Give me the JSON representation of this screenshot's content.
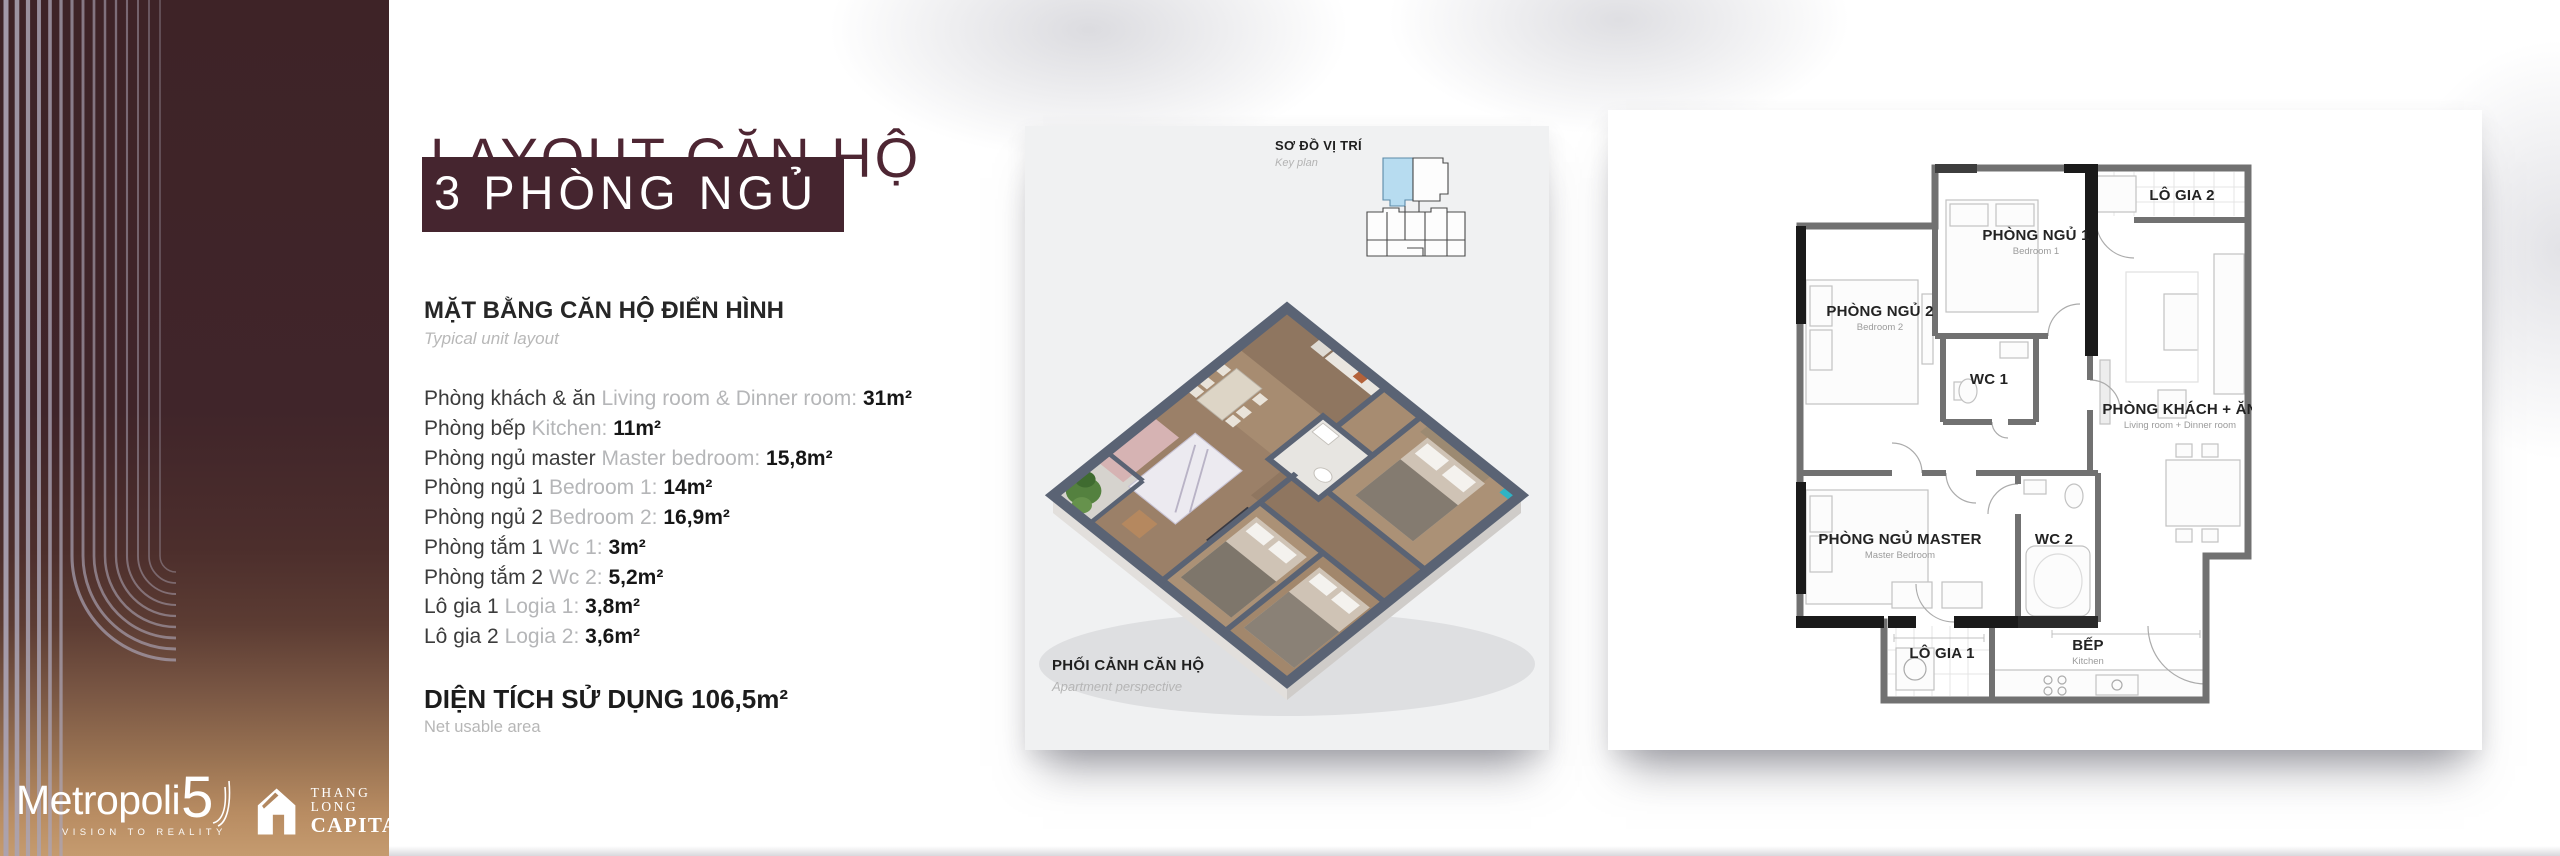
{
  "title": {
    "line1": "LAYOUT CĂN HỘ",
    "line2": "3 PHÒNG NGỦ"
  },
  "sidebar": {
    "brand": {
      "name_main": "Metropoli",
      "name_number": "5",
      "tagline": "VISION TO REALITY",
      "partner_line1": "THANG LONG",
      "partner_line2": "CAPITAL"
    }
  },
  "details": {
    "heading_vi": "MẶT BẰNG CĂN HỘ ĐIỂN HÌNH",
    "heading_en": "Typical unit layout",
    "rooms": [
      {
        "vi": "Phòng khách & ăn",
        "en": "Living room & Dinner room:",
        "area": "31m²"
      },
      {
        "vi": "Phòng bếp",
        "en": "Kitchen:",
        "area": "11m²"
      },
      {
        "vi": "Phòng ngủ master",
        "en": "Master bedroom:",
        "area": "15,8m²"
      },
      {
        "vi": "Phòng ngủ 1",
        "en": "Bedroom 1:",
        "area": "14m²"
      },
      {
        "vi": "Phòng ngủ 2",
        "en": "Bedroom 2:",
        "area": "16,9m²"
      },
      {
        "vi": "Phòng tắm 1",
        "en": "Wc 1:",
        "area": "3m²"
      },
      {
        "vi": "Phòng tắm 2",
        "en": "Wc 2:",
        "area": "5,2m²"
      },
      {
        "vi": "Lô gia 1",
        "en": "Logia 1:",
        "area": "3,8m²"
      },
      {
        "vi": "Lô gia 2",
        "en": "Logia 2:",
        "area": "3,6m²"
      }
    ],
    "total_label": "DIỆN TÍCH SỬ DỤNG",
    "total_value": "106,5m²",
    "total_en": "Net usable area"
  },
  "perspective_card": {
    "keyplan_title": "SƠ ĐỒ VỊ TRÍ",
    "keyplan_sub": "Key plan",
    "caption_title": "PHỐI CẢNH CĂN HỘ",
    "caption_sub": "Apartment perspective"
  },
  "floorplan_card": {
    "labels": [
      {
        "vi": "LÔ GIA 2",
        "en": ""
      },
      {
        "vi": "PHÒNG NGỦ 1",
        "en": "Bedroom 1"
      },
      {
        "vi": "PHÒNG NGỦ 2",
        "en": "Bedroom 2"
      },
      {
        "vi": "WC 1",
        "en": ""
      },
      {
        "vi": "PHÒNG KHÁCH + ĂN",
        "en": "Living room + Dinner room"
      },
      {
        "vi": "PHÒNG NGỦ MASTER",
        "en": "Master Bedroom"
      },
      {
        "vi": "WC 2",
        "en": ""
      },
      {
        "vi": "LÔ GIA 1",
        "en": ""
      },
      {
        "vi": "BẾP",
        "en": "Kitchen"
      }
    ]
  },
  "colors": {
    "maroon_banner": "#45252f",
    "title_text": "#4e2633",
    "sidebar_top": "#3e2327",
    "sidebar_bottom": "#c59b6f",
    "stripe": "#aaa3b3",
    "card_gray": "#f0f1f2",
    "keyplan_highlight": "#b7dcf0",
    "plan_wall_gray": "#717171",
    "plan_wall_black": "#1a1a1a",
    "iso_wall": "#5a6374",
    "text_gray": "#b5b6b8"
  }
}
